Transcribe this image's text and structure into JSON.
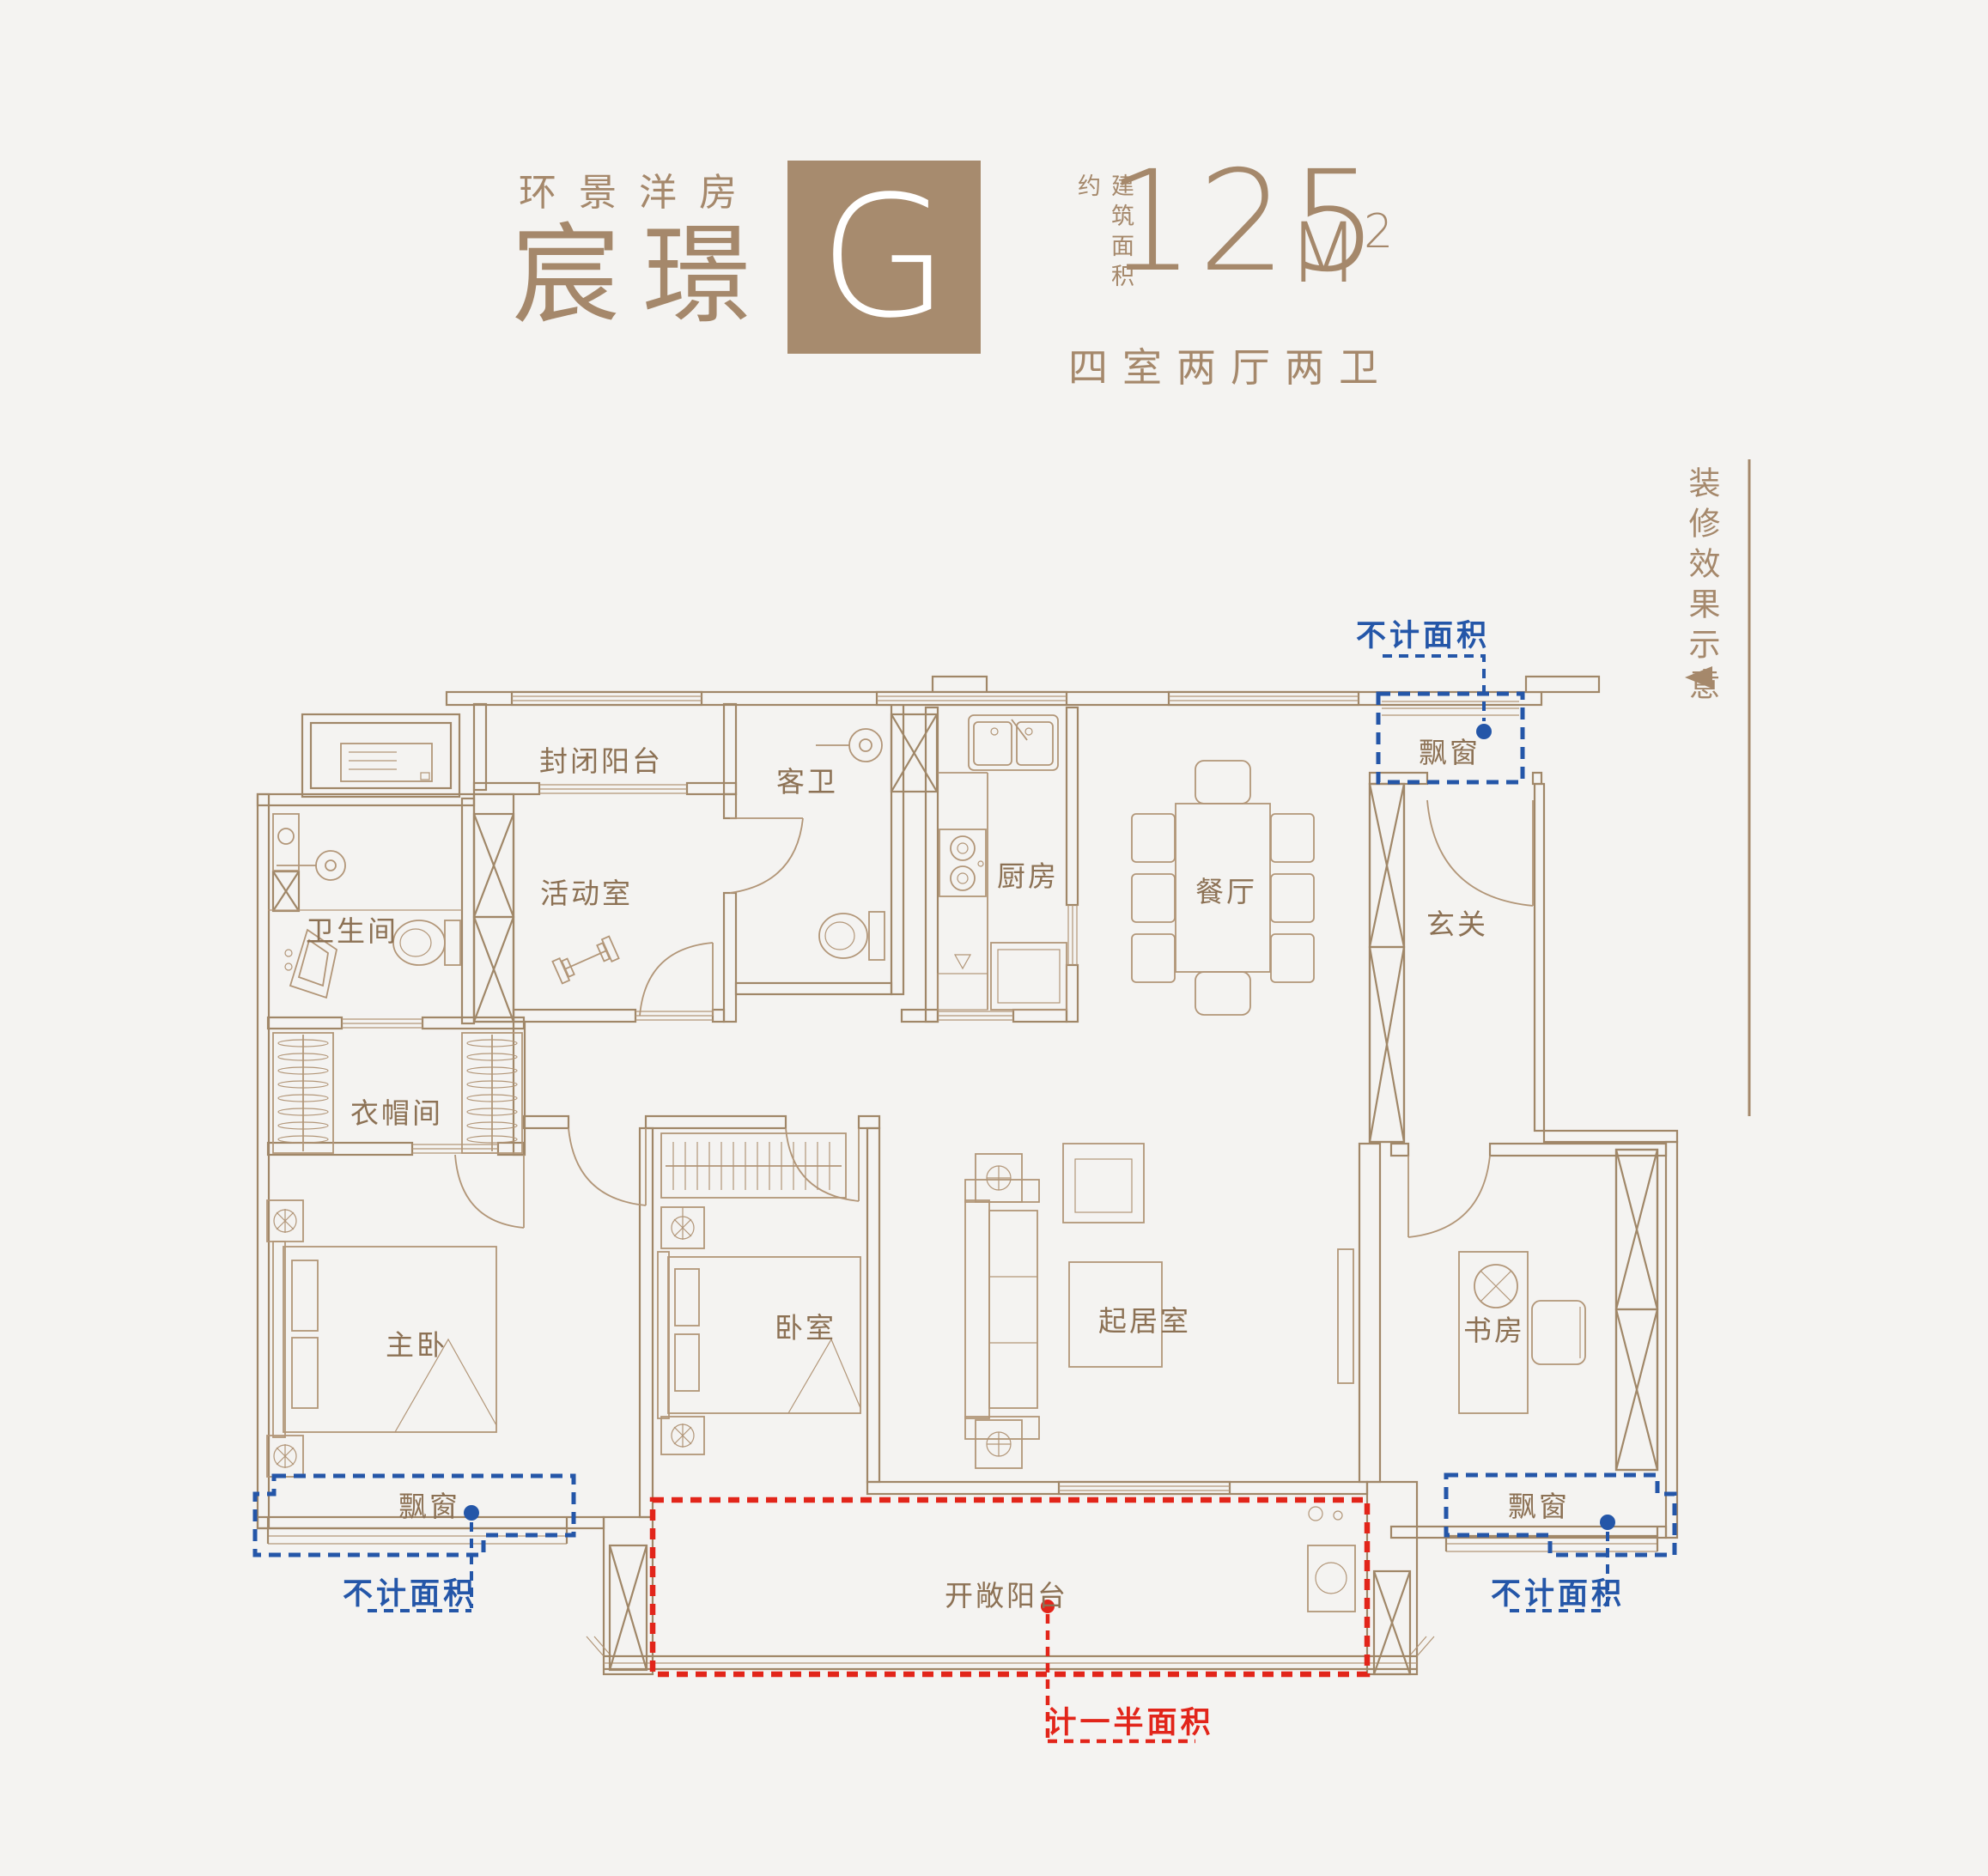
{
  "header": {
    "series": "环景洋房",
    "unit_name": "宸璟",
    "unit_letter": "G",
    "area_label": "建筑面积约",
    "area_value": "125",
    "area_unit": "M",
    "area_exponent": "2",
    "layout": "四室两厅两卫"
  },
  "side_note": {
    "caption": "装修效果示意"
  },
  "rooms": {
    "enclosed_balcony": "封闭阳台",
    "guest_bath": "客卫",
    "kitchen": "厨房",
    "dining": "餐厅",
    "foyer": "玄关",
    "bathroom": "卫生间",
    "activity": "活动室",
    "cloakroom": "衣帽间",
    "master_bedroom": "主卧",
    "bedroom": "卧室",
    "living": "起居室",
    "study": "书房",
    "open_balcony": "开敞阳台"
  },
  "annotations": {
    "bay_window": "飘窗",
    "excluded_area": "不计面积",
    "half_area": "计一半面积"
  },
  "colors": {
    "bg": "#f4f3f1",
    "accent": "#a5886b",
    "gbox": "#a78b6e",
    "wall": "#a08768",
    "furn": "#b29678",
    "label": "#8c7154",
    "blue": "#2456a8",
    "red": "#e2251a"
  }
}
